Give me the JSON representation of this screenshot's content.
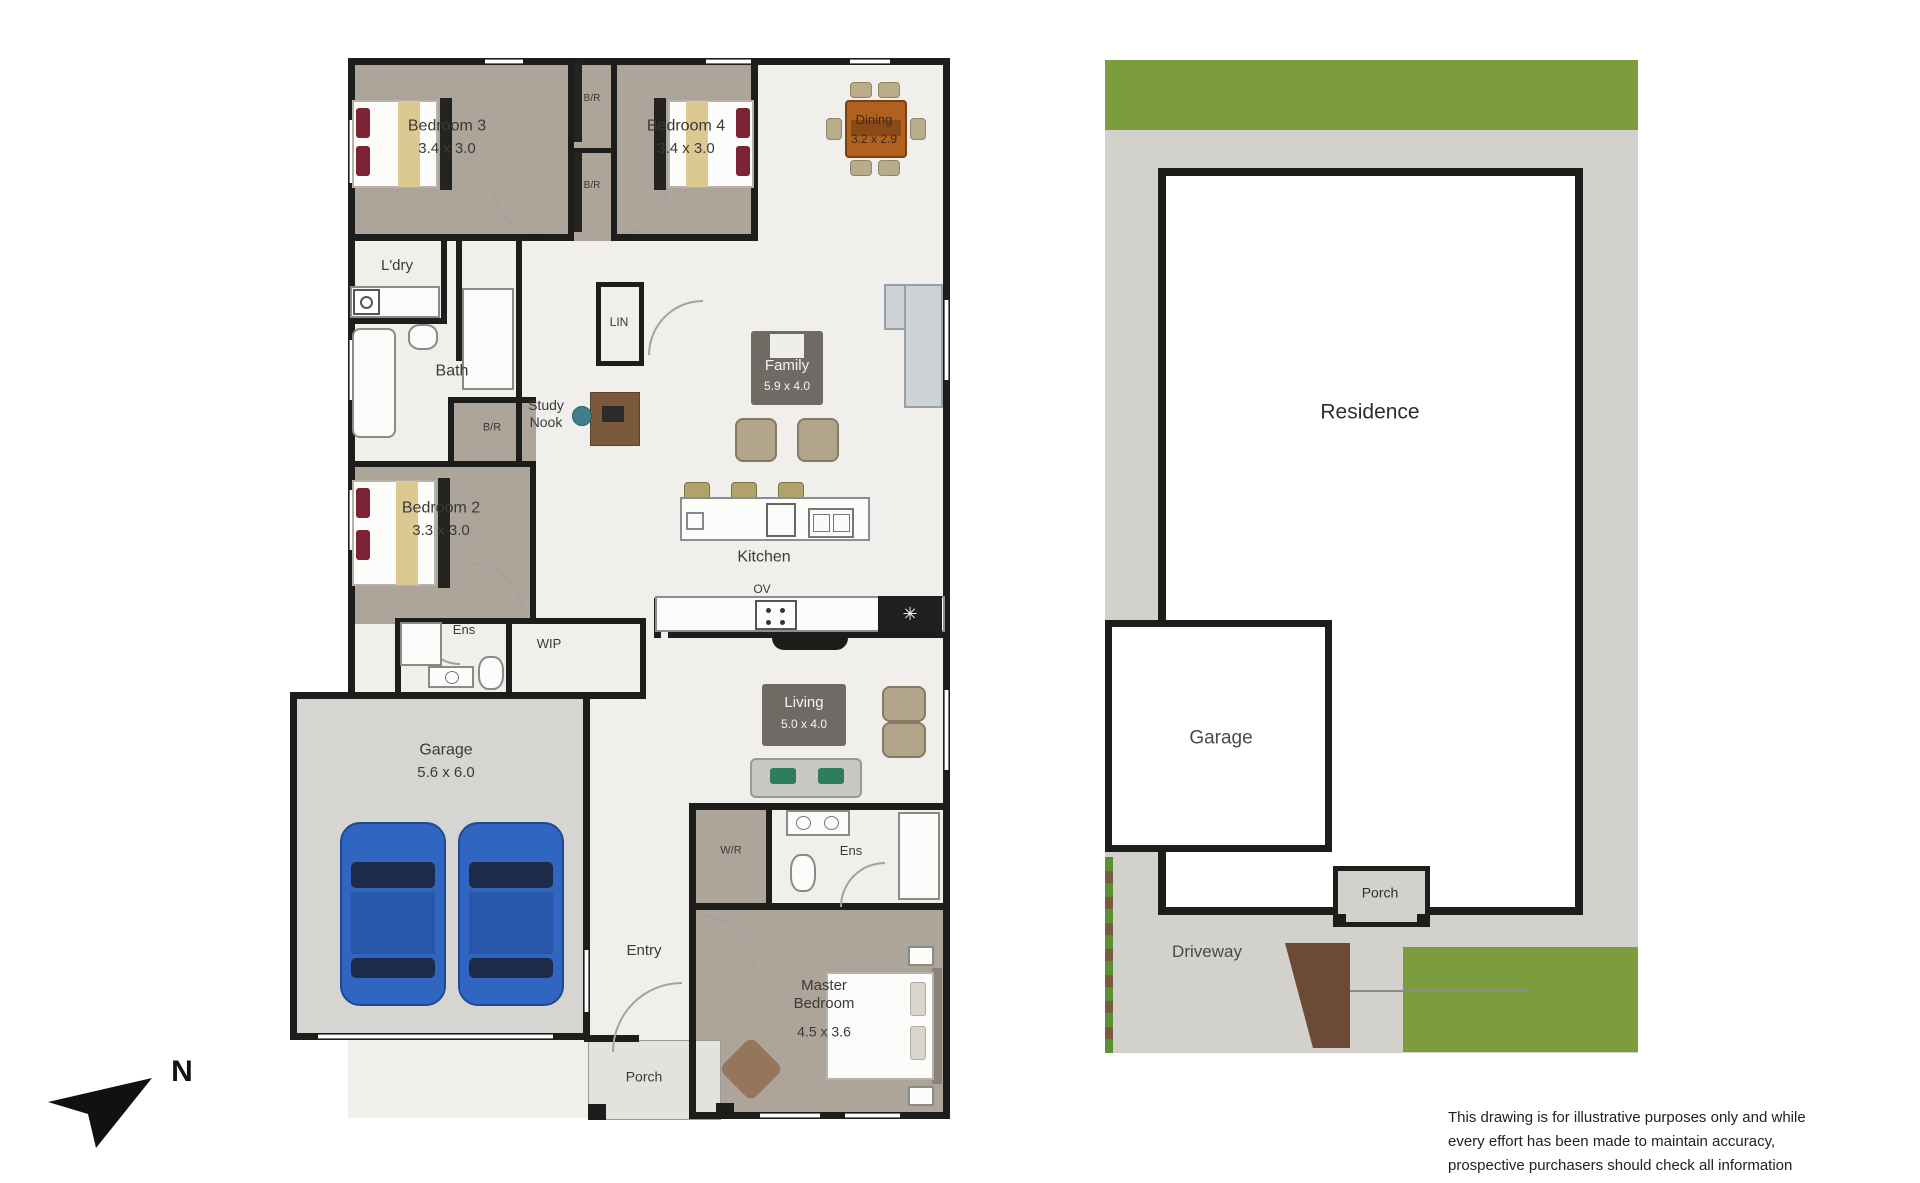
{
  "floor_plan": {
    "rooms": {
      "bedroom3": {
        "name": "Bedroom 3",
        "dims": "3.4 x 3.0"
      },
      "bedroom4": {
        "name": "Bedroom 4",
        "dims": "3.4 x 3.0"
      },
      "bedroom2": {
        "name": "Bedroom 2",
        "dims": "3.3 x 3.0"
      },
      "master_bedroom": {
        "name": "Master Bedroom",
        "dims": "4.5 x 3.6"
      },
      "dining": {
        "name": "Dining",
        "dims": "3.2 x 2.9"
      },
      "family": {
        "name": "Family",
        "dims": "5.9 x 4.0"
      },
      "living": {
        "name": "Living",
        "dims": "5.0 x 4.0"
      },
      "kitchen": {
        "name": "Kitchen",
        "oven": "OV"
      },
      "garage": {
        "name": "Garage",
        "dims": "5.6 x 6.0"
      },
      "laundry": {
        "name": "L'dry"
      },
      "bath": {
        "name": "Bath"
      },
      "linen": {
        "name": "LIN"
      },
      "study_nook": {
        "name": "Study Nook"
      },
      "robe": {
        "name": "B/R"
      },
      "walk_in_pantry": {
        "name": "WIP"
      },
      "walk_in_robe": {
        "name": "W/R"
      },
      "ensuite": {
        "name": "Ens"
      },
      "entry": {
        "name": "Entry"
      },
      "porch": {
        "name": "Porch"
      }
    },
    "compass": {
      "north_label": "N"
    }
  },
  "site_plan": {
    "residence_label": "Residence",
    "garage_label": "Garage",
    "porch_label": "Porch",
    "driveway_label": "Driveway"
  },
  "disclaimer": {
    "line1": "This drawing is for illustrative purposes only and while",
    "line2": "every effort has been made to maintain accuracy,",
    "line3": "prospective purchasers should check all information"
  },
  "colors": {
    "wall": "#1d1d1b",
    "wood_floor": "#ada49a",
    "light_floor": "#f0efec",
    "garage_floor": "#d6d5d1",
    "site_ground": "#d2d1cb",
    "grass_green": "#7d9c3e",
    "car_blue": "#3066c2",
    "pillow_maroon": "#7c2433",
    "furniture_tan": "#b9ac88",
    "cabinet_gray": "#6f6b64",
    "table_brown": "#b0601f",
    "sofa_green": "#2e7d5b"
  }
}
